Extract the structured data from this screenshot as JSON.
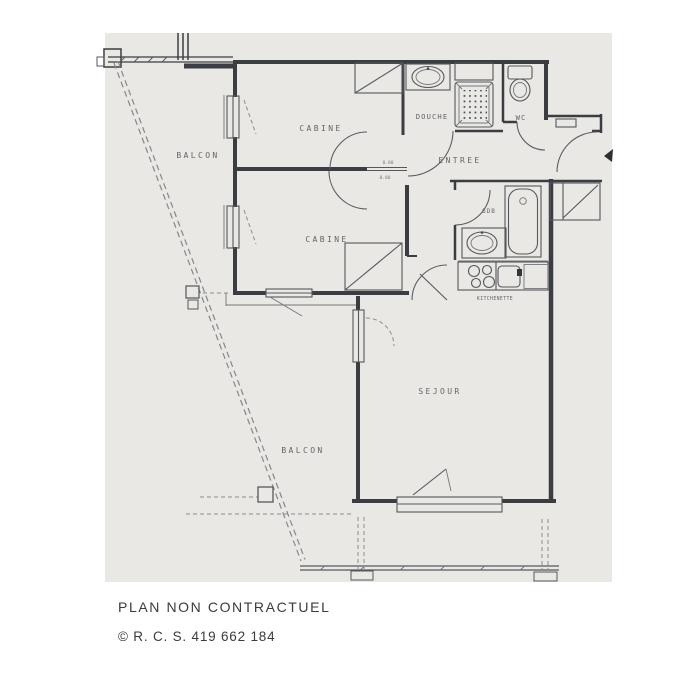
{
  "scan": {
    "paper_color": "#e9e8e4",
    "ink_color": "#3b3d42",
    "medium_ink_color": "#55575c",
    "light_ink_color": "#85878c",
    "label_color": "#4c4e54"
  },
  "floorplan": {
    "labels": {
      "balcon_top": "BALCON",
      "cabine_top": "CABINE",
      "cabine_bottom": "CABINE",
      "douche": "DOUCHE",
      "wc": "WC",
      "entree": "ENTREE",
      "sdb": "SDB",
      "kitchenette": "KITCHENETTE",
      "sejour": "SEJOUR",
      "balcon_bottom": "BALCON",
      "door_dim_top": "0.80",
      "door_dim_bottom": "0.80"
    }
  },
  "footer": {
    "line1": "PLAN NON CONTRACTUEL",
    "line2": "© R. C. S. 419 662 184"
  }
}
